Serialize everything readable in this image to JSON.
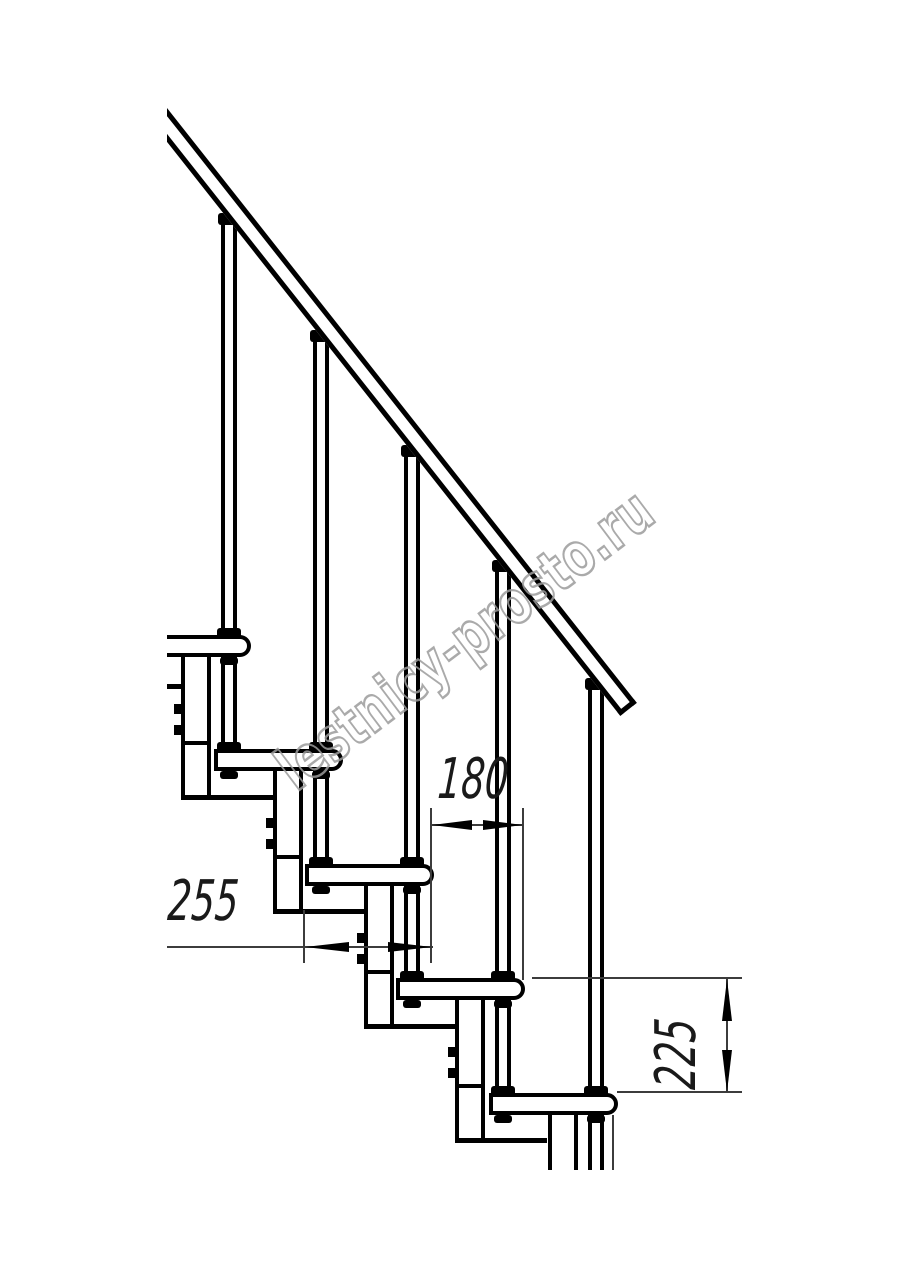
{
  "watermark": {
    "text": "lestnicy-prosto.ru",
    "stroke_color": "#9c9c9c"
  },
  "dimensions": {
    "tread_depth": {
      "label": "255",
      "orientation": "horizontal"
    },
    "going": {
      "label": "180",
      "orientation": "horizontal"
    },
    "step_height": {
      "label": "225",
      "orientation": "vertical"
    }
  },
  "colors": {
    "ink": "#000000",
    "thin_line": "#3c3c3c",
    "background": "#ffffff"
  }
}
